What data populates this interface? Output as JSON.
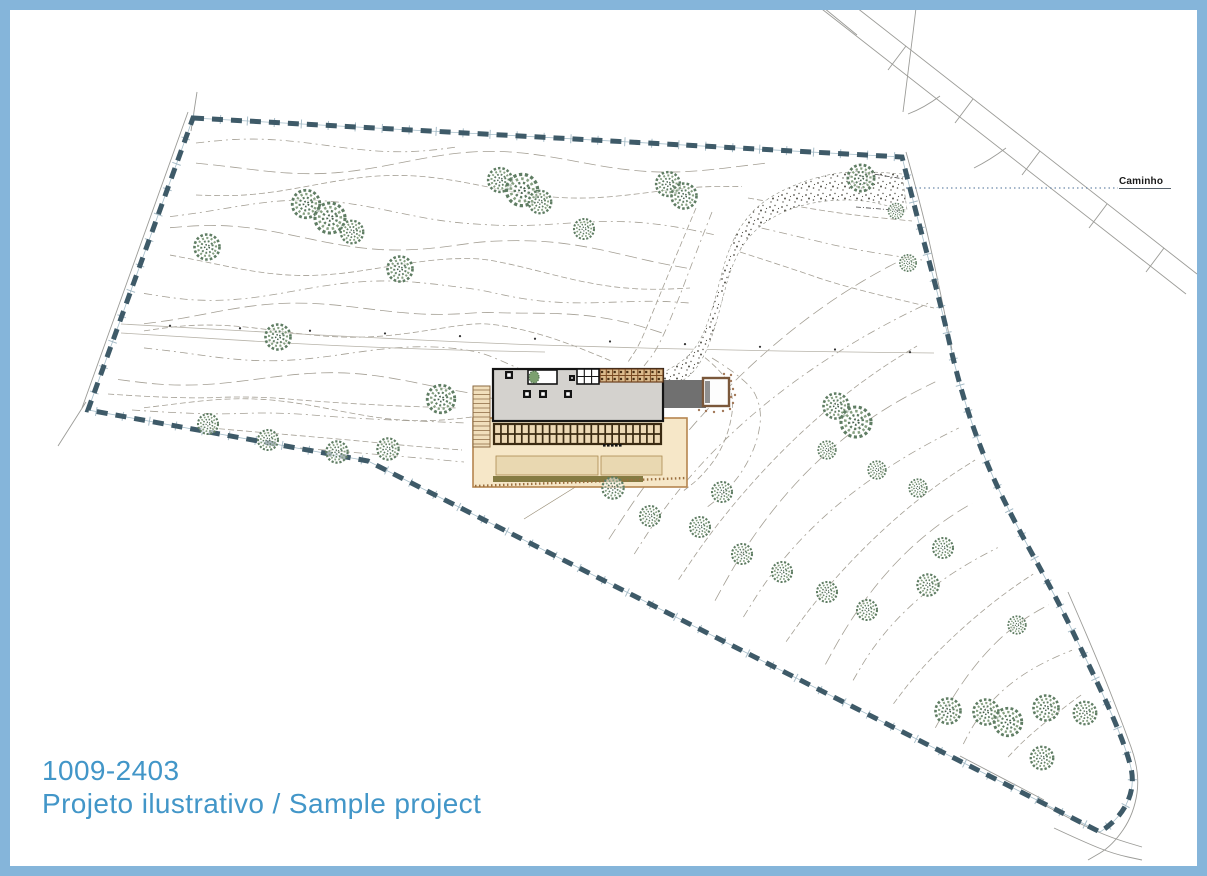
{
  "title_block": {
    "code": "1009-2403",
    "subtitle": "Projeto ilustrativo / Sample project"
  },
  "labels": {
    "path_label": "Caminho"
  },
  "colors": {
    "frame_border": "#85b5da",
    "background": "#ffffff",
    "title_text": "#4296c8",
    "caminho_text": "#1a1a1a",
    "boundary_dash": "#3e5a68",
    "boundary_underlay": "#a5bdc9",
    "boundary_ticks": "#9fb6c2",
    "contour_line": "#a49f94",
    "road_line": "#9b9b97",
    "leader_dotted": "#4a6e96",
    "tree_outline": "#5f7d63",
    "tree_inner": "#86a081",
    "gravel_dot": "#55524a",
    "roof_fill": "#d4d2ce",
    "roof_outline": "#141414",
    "terrace_fill": "#f6e7c8",
    "terrace_border": "#b5854f",
    "terrace_inner_fill": "#e9d8b1",
    "pergola_fill": "#ecd8b4",
    "pergola_grid": "#3a2a12",
    "deck_fill": "#dcbc8e",
    "deck_grid": "#7a4a22",
    "stairs_fill": "#f1dfbc",
    "stairs_line": "#8a6a42",
    "driveway_fill": "#707070",
    "garage_border": "#7a573a",
    "olive_strip": "#857b42",
    "courtyard_tree": "#7ca06f"
  }
}
